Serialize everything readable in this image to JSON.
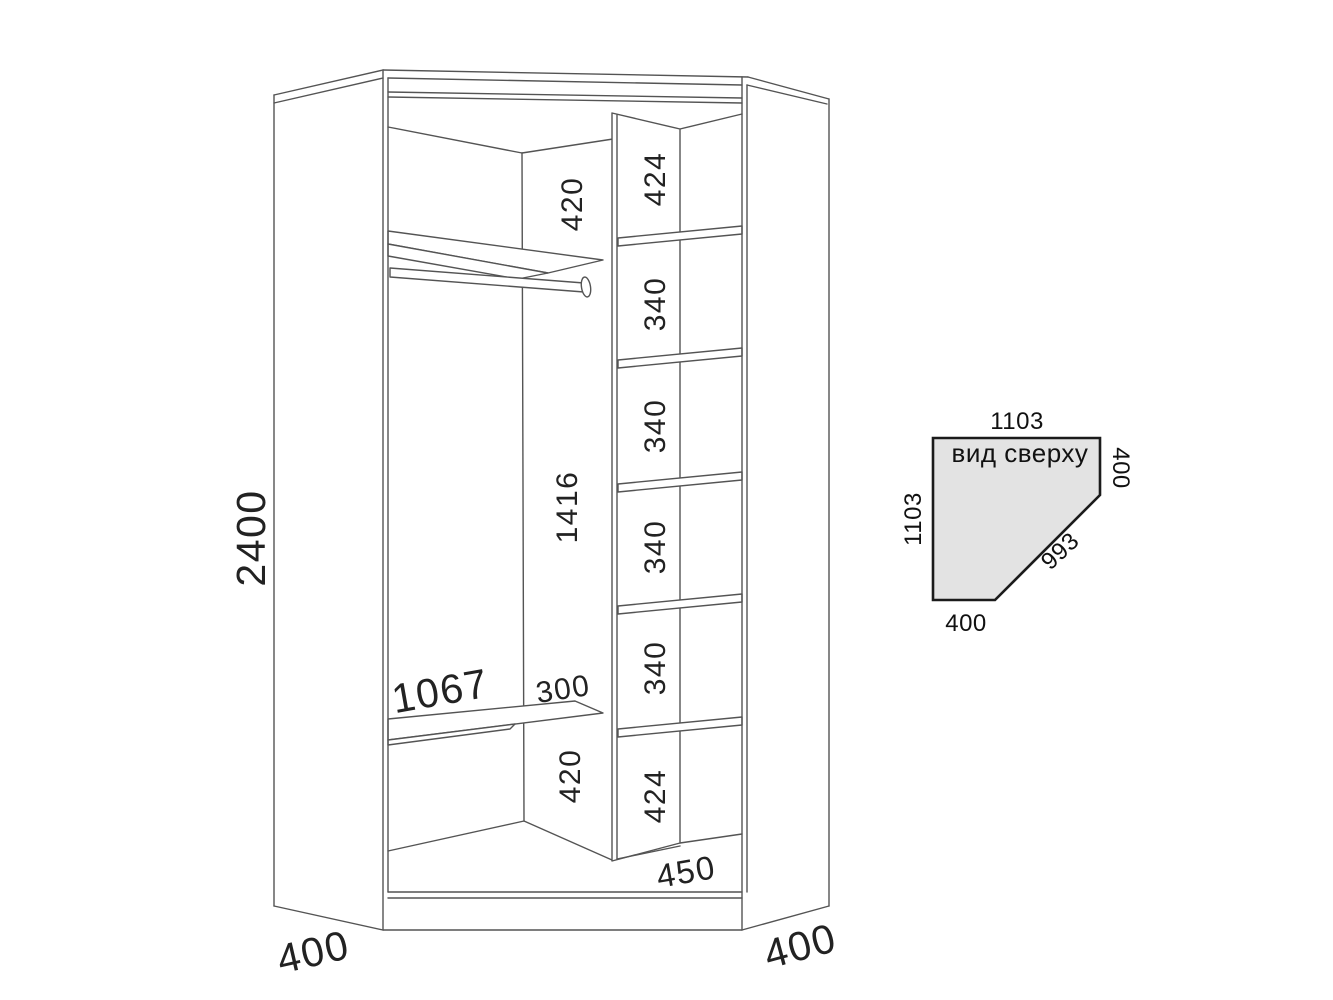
{
  "colors": {
    "background": "#ffffff",
    "drawing_line": "#545454",
    "dimension_text": "#222222",
    "top_view_fill": "#e3e3e3",
    "top_view_line": "#1b1b1b"
  },
  "front_view": {
    "total_height": "2400",
    "left_side_depth": "400",
    "right_side_depth": "400",
    "left_section": {
      "top_gap": "420",
      "middle_height": "1416",
      "shelf_length": "1067",
      "shelf_to_divider_gap": "300",
      "bottom_gap": "420"
    },
    "shelf_column": {
      "sections": [
        "424",
        "340",
        "340",
        "340",
        "340",
        "424"
      ],
      "column_depth": "450"
    }
  },
  "top_view": {
    "title": "вид сверху",
    "top_edge": "1103",
    "left_edge": "1103",
    "right_edge": "400",
    "bottom_edge": "400",
    "front_diagonal": "993"
  }
}
